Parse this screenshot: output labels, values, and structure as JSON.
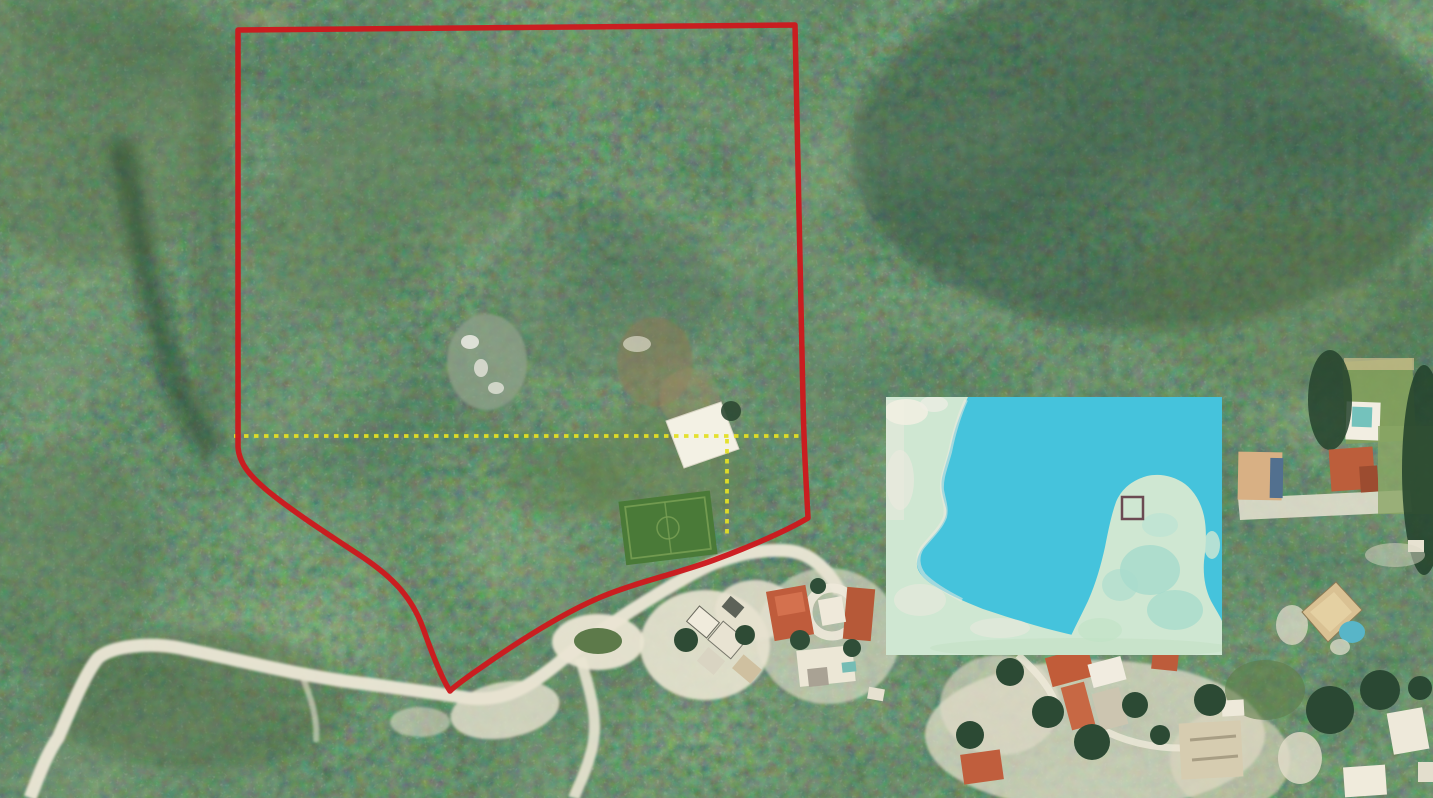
{
  "scene": {
    "kind": "satellite-aerial-photo",
    "description": "aerial view of a forested land parcel with overlay annotations",
    "palette": {
      "forest_dark": "#22402c",
      "forest_mid": "#2e4c36",
      "forest_light": "#5d7a4c",
      "road_sand": "#ece7d6",
      "roof_orange": "#c05c3c",
      "pool_teal": "#6fc0bb",
      "field_green": "#4a7a38"
    }
  },
  "boundary": {
    "color": "#cc1a1e",
    "stroke_width": 5.5,
    "path_d": "M 238,30 L 795,25 C 798,120 800,260 803,400 C 804,452 807,498 808,518 C 788,530 752,546 714,560 C 676,574 640,581 601,597 C 561,614 516,643 479,669 C 469,676 456,685 450,691 C 444,682 434,659 423,628 C 412,598 394,578 361,556 C 329,535 295,513 269,492 C 251,477 239,464 238,447 Z"
  },
  "survey_lines": {
    "color": "#e3df25",
    "dash": "4.5 5.5",
    "stroke_width": 3.8,
    "horizontal": {
      "x1": 234,
      "y1": 436,
      "x2": 799,
      "y2": 436
    },
    "vertical": {
      "x1": 727,
      "y1": 439,
      "x2": 727,
      "y2": 538
    }
  },
  "inset_map": {
    "x": 886,
    "y": 397,
    "width": 336,
    "height": 258,
    "water_color": "#45c3dc",
    "land_color": "#cfe7d2",
    "mainland_path_d": "M 886,397 L 968,397 C 962,410 956,424 952,441 C 949,455 945,465 942,478 C 940,490 944,500 946,508 C 948,517 941,527 933,536 C 925,545 918,552 917,562 C 916,571 923,578 933,585 C 947,594 963,601 983,609 C 1004,616 1029,624 1056,631 C 1083,638 1111,643 1141,648 C 1171,652 1199,654 1222,655 L 886,655 Z",
    "peninsula_path_d": "M 1063,655 C 1069,638 1079,620 1088,601 C 1096,583 1101,565 1105,547 C 1108,532 1111,516 1116,502 C 1122,488 1133,480 1147,476 C 1160,473 1174,476 1185,484 C 1194,491 1201,502 1204,516 C 1207,530 1206,546 1204,561 C 1203,575 1205,589 1211,601 C 1216,610 1220,616 1222,621 L 1222,655 Z",
    "marker": {
      "x": 1122,
      "y": 497,
      "w": 21,
      "h": 22,
      "color": "#6b4a52",
      "stroke_width": 2.5
    }
  }
}
